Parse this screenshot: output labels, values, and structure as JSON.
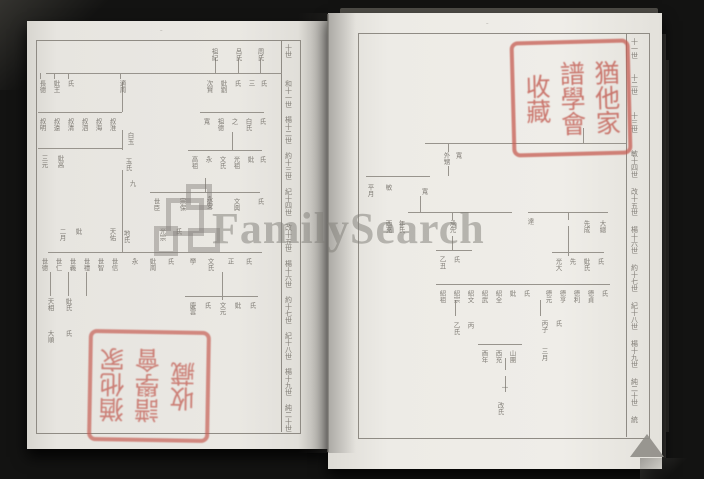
{
  "scene": {
    "background_color": "#131312",
    "page_color": "#e9e7e2",
    "chart_line_color": "#98948d",
    "chart_text_color": "#6f6b64",
    "seal_color": "#c2645c",
    "watermark_color": "#7d7b75"
  },
  "watermark": {
    "text": "FamilySearch",
    "logo": "familysearch-tree-logo"
  },
  "seal": {
    "full_text": "猶他家譜學會收藏",
    "columns": [
      "猶他家",
      "譜學會",
      "收藏"
    ]
  },
  "left_page": {
    "page_mark": "–",
    "generation_x": 284,
    "generation_labels": [
      {
        "y": 44,
        "t": "十世"
      },
      {
        "y": 80,
        "t": "和十一世"
      },
      {
        "y": 116,
        "t": "楊十二世"
      },
      {
        "y": 152,
        "t": "約十三世"
      },
      {
        "y": 188,
        "t": "紀十四世"
      },
      {
        "y": 224,
        "t": "改十五世"
      },
      {
        "y": 260,
        "t": "楊十六世"
      },
      {
        "y": 296,
        "t": "約十七世"
      },
      {
        "y": 332,
        "t": "紀十八世"
      },
      {
        "y": 368,
        "t": "楊十九世"
      },
      {
        "y": 404,
        "t": "純二十世"
      }
    ],
    "chart": {
      "lines": [
        [
          46,
          73,
          236,
          1
        ],
        [
          215,
          58,
          1,
          15
        ],
        [
          238,
          58,
          1,
          15
        ],
        [
          260,
          58,
          1,
          15
        ],
        [
          40,
          73,
          1,
          6
        ],
        [
          54,
          73,
          1,
          6
        ],
        [
          68,
          73,
          1,
          6
        ],
        [
          120,
          73,
          1,
          6
        ],
        [
          38,
          112,
          84,
          1
        ],
        [
          200,
          112,
          64,
          1
        ],
        [
          122,
          82,
          1,
          30
        ],
        [
          122,
          130,
          1,
          20
        ],
        [
          38,
          148,
          85,
          1
        ],
        [
          232,
          132,
          1,
          18
        ],
        [
          188,
          150,
          74,
          1
        ],
        [
          122,
          170,
          1,
          24
        ],
        [
          205,
          178,
          1,
          14
        ],
        [
          150,
          192,
          110,
          1
        ],
        [
          122,
          194,
          1,
          58
        ],
        [
          48,
          252,
          214,
          1
        ],
        [
          50,
          272,
          1,
          24
        ],
        [
          68,
          272,
          1,
          24
        ],
        [
          86,
          272,
          1,
          24
        ],
        [
          222,
          272,
          1,
          28
        ],
        [
          185,
          296,
          73,
          1
        ]
      ],
      "labels": [
        [
          210,
          48,
          "祖紀"
        ],
        [
          234,
          48,
          "呂氏"
        ],
        [
          256,
          48,
          "周氏"
        ],
        [
          38,
          80,
          "長德"
        ],
        [
          52,
          80,
          "妣王"
        ],
        [
          66,
          80,
          "氏"
        ],
        [
          118,
          80,
          "適周"
        ],
        [
          205,
          80,
          "次賢"
        ],
        [
          219,
          80,
          "妣劉"
        ],
        [
          233,
          80,
          "氏"
        ],
        [
          247,
          80,
          "三"
        ],
        [
          259,
          80,
          "氏"
        ],
        [
          38,
          118,
          "叔明"
        ],
        [
          52,
          118,
          "叔遠"
        ],
        [
          66,
          118,
          "叔清"
        ],
        [
          80,
          118,
          "叔泗"
        ],
        [
          94,
          118,
          "叔海"
        ],
        [
          108,
          118,
          "叔淮"
        ],
        [
          202,
          118,
          "寬"
        ],
        [
          216,
          118,
          "祖德"
        ],
        [
          230,
          118,
          "之"
        ],
        [
          244,
          118,
          "白氏"
        ],
        [
          258,
          118,
          "氏"
        ],
        [
          126,
          132,
          "白玉"
        ],
        [
          40,
          155,
          "三元"
        ],
        [
          56,
          155,
          "妣高"
        ],
        [
          124,
          158,
          "玉氏"
        ],
        [
          190,
          156,
          "高祖"
        ],
        [
          204,
          156,
          "永"
        ],
        [
          218,
          156,
          "文氏"
        ],
        [
          232,
          156,
          "光祖"
        ],
        [
          246,
          156,
          "妣"
        ],
        [
          258,
          156,
          "氏"
        ],
        [
          128,
          180,
          "九"
        ],
        [
          152,
          198,
          "世臣"
        ],
        [
          178,
          198,
          "宗保"
        ],
        [
          205,
          196,
          "永安"
        ],
        [
          232,
          198,
          "文興"
        ],
        [
          256,
          198,
          "氏"
        ],
        [
          58,
          228,
          "二月"
        ],
        [
          74,
          228,
          "妣"
        ],
        [
          108,
          228,
          "天佑"
        ],
        [
          122,
          230,
          "地氏"
        ],
        [
          158,
          228,
          "光宗"
        ],
        [
          174,
          228,
          "氏"
        ],
        [
          40,
          258,
          "世德"
        ],
        [
          54,
          258,
          "世仁"
        ],
        [
          68,
          258,
          "世義"
        ],
        [
          82,
          258,
          "世禮"
        ],
        [
          96,
          258,
          "世智"
        ],
        [
          110,
          258,
          "世信"
        ],
        [
          130,
          258,
          "永"
        ],
        [
          148,
          258,
          "妣周"
        ],
        [
          166,
          258,
          "氏"
        ],
        [
          188,
          258,
          "學"
        ],
        [
          206,
          258,
          "文氏"
        ],
        [
          226,
          258,
          "正"
        ],
        [
          244,
          258,
          "氏"
        ],
        [
          46,
          298,
          "天相"
        ],
        [
          64,
          298,
          "妣氏"
        ],
        [
          188,
          302,
          "慶雲"
        ],
        [
          203,
          302,
          "氏"
        ],
        [
          218,
          302,
          "文元"
        ],
        [
          233,
          302,
          "妣"
        ],
        [
          248,
          302,
          "氏"
        ],
        [
          46,
          330,
          "大順"
        ],
        [
          64,
          330,
          "氏"
        ]
      ]
    }
  },
  "right_page": {
    "page_mark": "–",
    "generation_x": 630,
    "generation_labels": [
      {
        "y": 38,
        "t": "十一世"
      },
      {
        "y": 74,
        "t": "十二世"
      },
      {
        "y": 112,
        "t": "十三世"
      },
      {
        "y": 150,
        "t": "敏十四世"
      },
      {
        "y": 188,
        "t": "改十五世"
      },
      {
        "y": 226,
        "t": "楊十六世"
      },
      {
        "y": 264,
        "t": "約十七世"
      },
      {
        "y": 302,
        "t": "紀十八世"
      },
      {
        "y": 340,
        "t": "楊十九世"
      },
      {
        "y": 378,
        "t": "純二十世"
      },
      {
        "y": 416,
        "t": "統"
      }
    ],
    "chart": {
      "lines": [
        [
          425,
          143,
          201,
          1
        ],
        [
          448,
          143,
          1,
          9
        ],
        [
          448,
          166,
          1,
          10
        ],
        [
          583,
          128,
          1,
          15
        ],
        [
          366,
          176,
          64,
          1
        ],
        [
          420,
          196,
          1,
          16
        ],
        [
          408,
          212,
          104,
          1
        ],
        [
          528,
          212,
          80,
          1
        ],
        [
          452,
          212,
          1,
          8
        ],
        [
          568,
          212,
          1,
          8
        ],
        [
          452,
          236,
          1,
          14
        ],
        [
          568,
          226,
          1,
          30
        ],
        [
          436,
          250,
          36,
          1
        ],
        [
          552,
          252,
          52,
          1
        ],
        [
          436,
          284,
          174,
          1
        ],
        [
          455,
          300,
          1,
          16
        ],
        [
          540,
          300,
          1,
          16
        ],
        [
          478,
          344,
          44,
          1
        ],
        [
          505,
          358,
          1,
          12
        ],
        [
          505,
          376,
          1,
          16
        ]
      ],
      "labels": [
        [
          442,
          152,
          "外甥"
        ],
        [
          454,
          152,
          "寬"
        ],
        [
          366,
          184,
          "平月"
        ],
        [
          384,
          184,
          "敏"
        ],
        [
          420,
          188,
          "寬"
        ],
        [
          384,
          220,
          "西充"
        ],
        [
          397,
          220,
          "年氏"
        ],
        [
          448,
          220,
          "承先"
        ],
        [
          526,
          218,
          "達"
        ],
        [
          582,
          220,
          "先成"
        ],
        [
          598,
          220,
          "大總"
        ],
        [
          438,
          256,
          "乙丑"
        ],
        [
          452,
          256,
          "氏"
        ],
        [
          554,
          258,
          "光大"
        ],
        [
          568,
          258,
          "先"
        ],
        [
          582,
          258,
          "妣氏"
        ],
        [
          596,
          258,
          "氏"
        ],
        [
          438,
          290,
          "紹祖"
        ],
        [
          452,
          290,
          "紹宗"
        ],
        [
          466,
          290,
          "紹文"
        ],
        [
          480,
          290,
          "紹武"
        ],
        [
          494,
          290,
          "紹全"
        ],
        [
          508,
          290,
          "妣"
        ],
        [
          522,
          290,
          "氏"
        ],
        [
          544,
          290,
          "德元"
        ],
        [
          558,
          290,
          "德亨"
        ],
        [
          572,
          290,
          "德利"
        ],
        [
          586,
          290,
          "德貞"
        ],
        [
          600,
          290,
          "氏"
        ],
        [
          452,
          322,
          "乙氏"
        ],
        [
          466,
          322,
          "丙"
        ],
        [
          540,
          320,
          "丙子"
        ],
        [
          554,
          320,
          "氏"
        ],
        [
          480,
          350,
          "酉年"
        ],
        [
          494,
          350,
          "西充"
        ],
        [
          508,
          350,
          "山團"
        ],
        [
          540,
          348,
          "三月"
        ],
        [
          500,
          384,
          "一"
        ],
        [
          496,
          402,
          "改氏"
        ]
      ]
    }
  }
}
